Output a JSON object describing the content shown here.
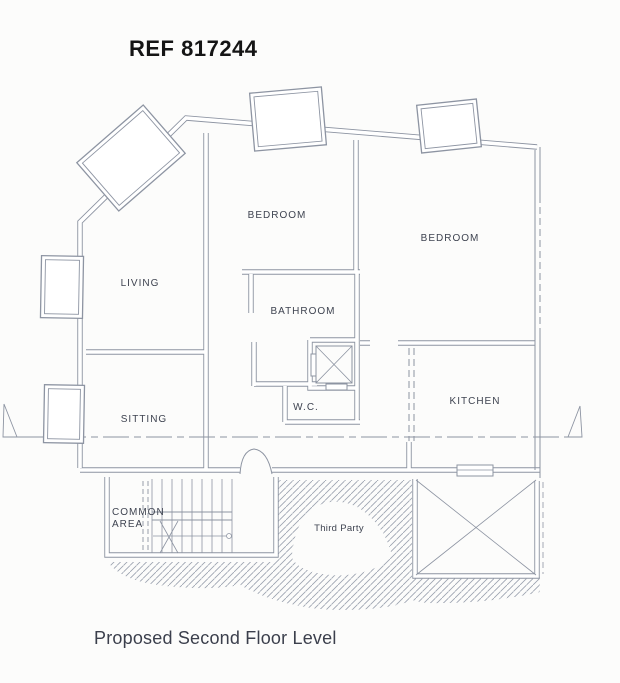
{
  "page": {
    "title": "REF 817244",
    "caption": "Proposed Second Floor Level"
  },
  "plan": {
    "rooms": [
      {
        "id": "living",
        "label": "LIVING"
      },
      {
        "id": "sitting",
        "label": "SITTING"
      },
      {
        "id": "bedroom-front",
        "label": "BEDROOM"
      },
      {
        "id": "bedroom-rear",
        "label": "BEDROOM"
      },
      {
        "id": "bathroom",
        "label": "BATHROOM"
      },
      {
        "id": "wc",
        "label": "W.C."
      },
      {
        "id": "kitchen",
        "label": "KITCHEN"
      },
      {
        "id": "common-area",
        "label": "COMMON AREA",
        "line1": "COMMON",
        "line2": "AREA"
      }
    ],
    "annotations": [
      {
        "id": "third-party",
        "label": "Third Party"
      }
    ],
    "features": [
      "staircase",
      "lift-shaft",
      "light-well",
      "window-grids",
      "door-arch",
      "centre-line",
      "third-party-hatch",
      "level-marker-triangles"
    ],
    "colors": {
      "ink": "#8d94a2",
      "label": "#3e4350",
      "title": "#151515",
      "caption": "#3b3f4c",
      "paper": "#fcfcfb",
      "core": "#ffffff"
    }
  }
}
